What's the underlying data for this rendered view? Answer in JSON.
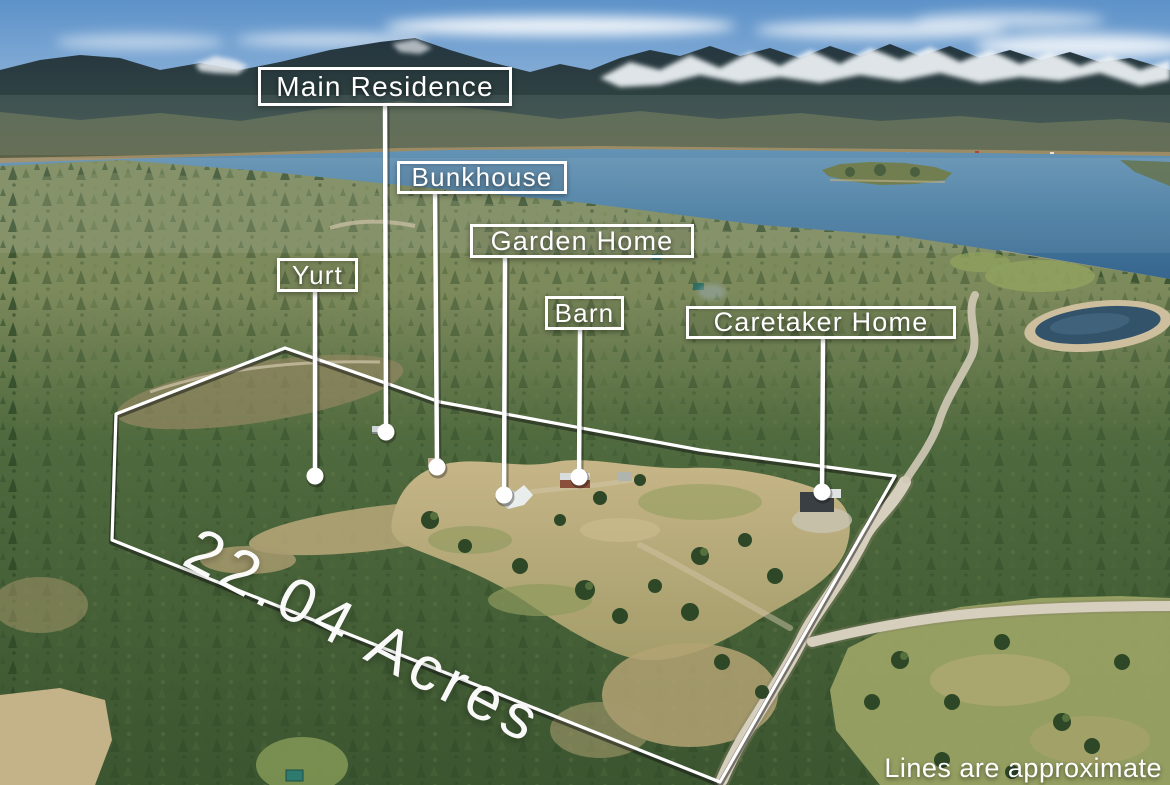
{
  "annotations": {
    "callouts": [
      {
        "id": "main-residence",
        "label": "Main Residence"
      },
      {
        "id": "bunkhouse",
        "label": "Bunkhouse"
      },
      {
        "id": "garden-home",
        "label": "Garden Home"
      },
      {
        "id": "yurt",
        "label": "Yurt"
      },
      {
        "id": "barn",
        "label": "Barn"
      },
      {
        "id": "caretaker-home",
        "label": "Caretaker Home"
      }
    ],
    "acreage_label": "22.04 Acres",
    "disclaimer": "Lines are approximate"
  },
  "colors": {
    "annotation_white": "#ffffff",
    "sky_blue": "#5d92c9",
    "lake_blue": "#3e6e94",
    "forest_green": "#46613a",
    "meadow_tan": "#b7a97c",
    "mountain_slate": "#243540",
    "snow_white": "#eef3f6"
  }
}
